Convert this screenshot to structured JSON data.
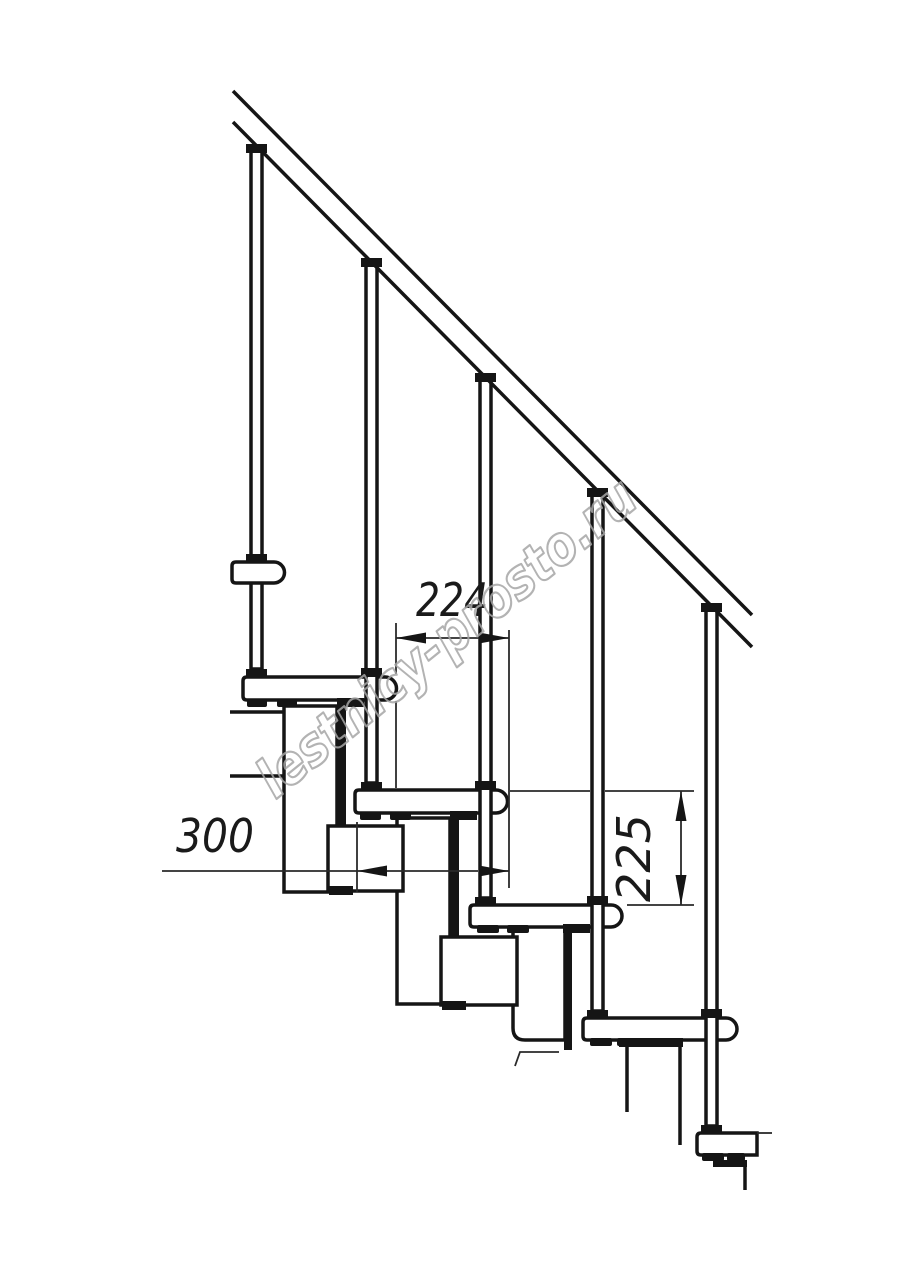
{
  "page": {
    "background": "#ffffff"
  },
  "drawing": {
    "type": "technical-drawing",
    "subject": "modular-staircase-side-elevation",
    "ink_color": "#151515",
    "dim_color": "#2a2a2a",
    "counts": {
      "balusters": 5,
      "treads": 5
    },
    "dimensions": {
      "step_run": "224",
      "tread_depth": "300",
      "step_height": "225"
    },
    "watermark": {
      "text": "lestnicy-prosto.ru",
      "color": "#a6a6a6"
    }
  }
}
